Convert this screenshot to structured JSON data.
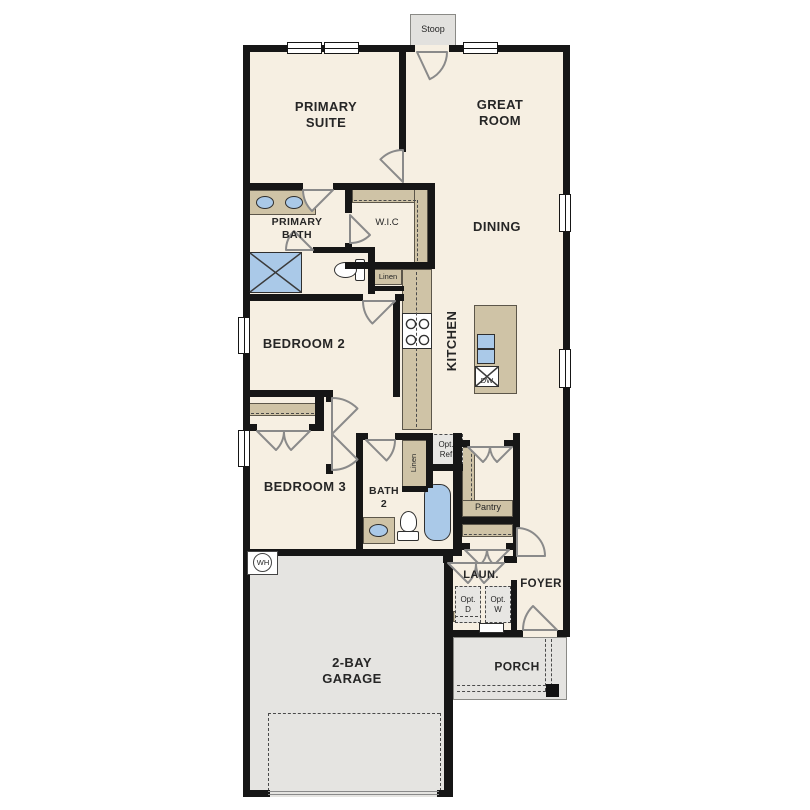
{
  "title": "single-story floor plan",
  "colors": {
    "floor": "#f6efe2",
    "wall": "#161616",
    "cabinet_tan": "#cfc3a6",
    "fixture_blue": "#aac9e8",
    "concrete_gray": "#e5e4e1",
    "door_stroke": "#8a8a8a",
    "text": "#262626"
  },
  "rooms": {
    "primary_suite": "PRIMARY\nSUITE",
    "great_room": "GREAT\nROOM",
    "primary_bath": "PRIMARY\nBATH",
    "wic": "W.I.C",
    "dining": "DINING",
    "kitchen": "KITCHEN",
    "bedroom2": "BEDROOM 2",
    "bedroom3": "BEDROOM 3",
    "bath2": "BATH\n2",
    "laundry": "LAUN.",
    "foyer": "FOYER",
    "porch": "PORCH",
    "garage": "2-BAY\nGARAGE"
  },
  "features": {
    "stoop": "Stoop",
    "linen_upper": "Linen",
    "linen_lower": "Linen",
    "pantry": "Pantry",
    "dishwasher": "DW",
    "water_heater": "WH",
    "opt_ref": "Opt.\nRef",
    "opt_dryer": "Opt.\nD",
    "opt_washer": "Opt.\nW"
  }
}
